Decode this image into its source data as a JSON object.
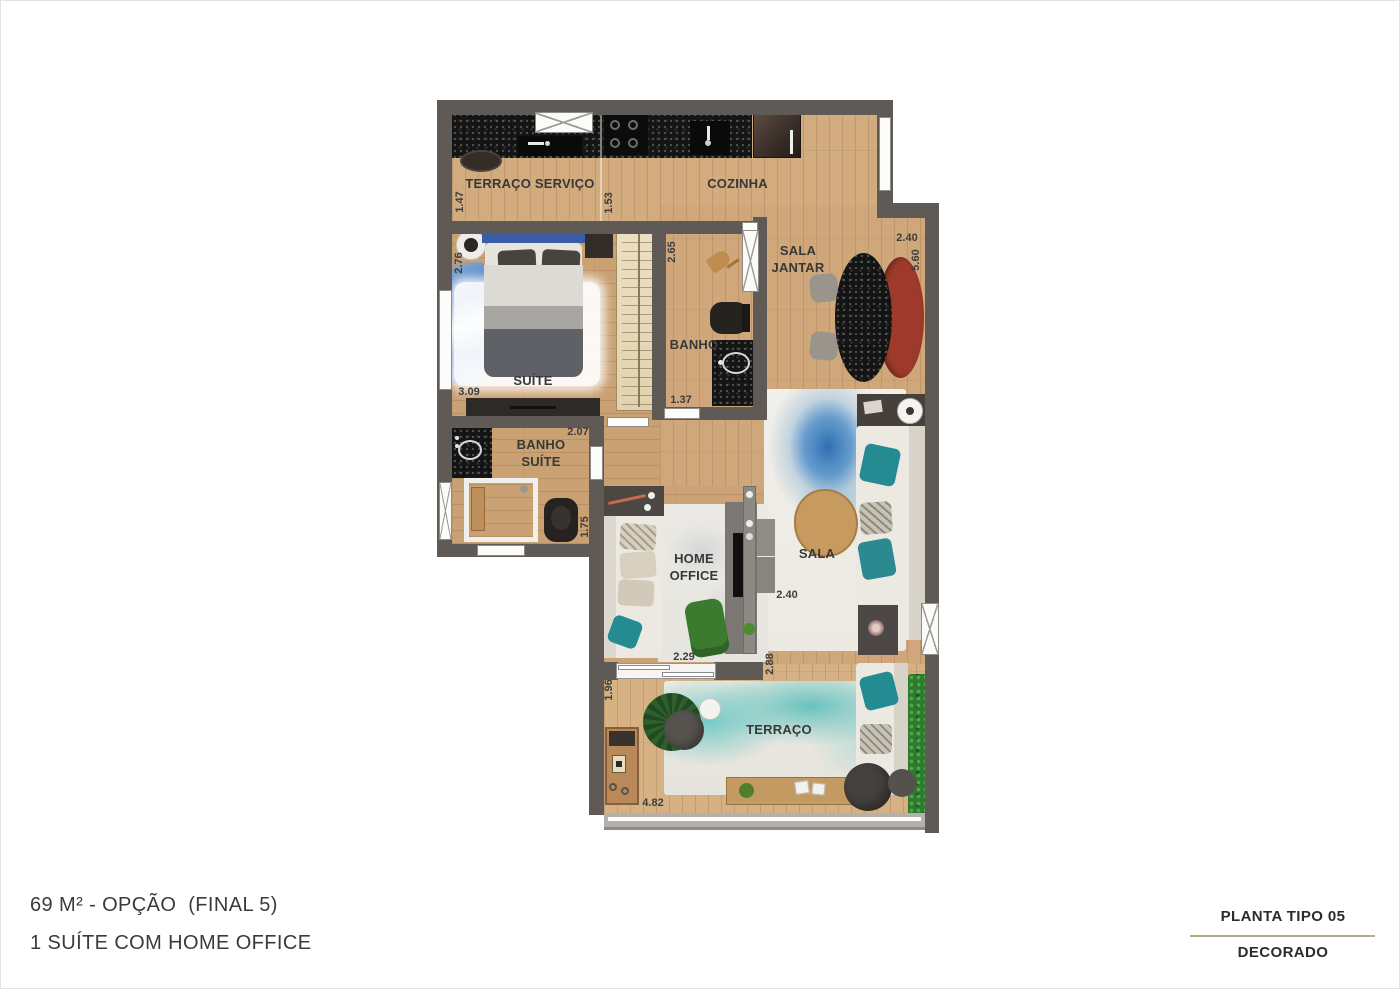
{
  "footer": {
    "area_title": "69 M² - OPÇÃO  (FINAL 5)",
    "area_subtitle": "1 SUÍTE COM HOME OFFICE",
    "plate_title": "PLANTA TIPO 05",
    "plate_subtitle": "DECORADO"
  },
  "rooms": {
    "terraco_servico": "TERRAÇO SERVIÇO",
    "cozinha": "COZINHA",
    "sala_jantar": "SALA JANTAR",
    "banho": "BANHO",
    "suite": "SUÍTE",
    "banho_suite": "BANHO SUÍTE",
    "home_office": "HOME OFFICE",
    "sala": "SALA",
    "terraco": "TERRAÇO"
  },
  "dims": {
    "servico_width": "1.47",
    "cozinha_width": "1.53",
    "banho_depth": "2.65",
    "jantar_width": "2.40",
    "jantar_depth": "5.60",
    "suite_width": "2.76",
    "suite_depth": "3.09",
    "hall_width": "1.37",
    "banho_suite_width": "2.07",
    "banho_suite_depth": "1.75",
    "home_office_width": "2.29",
    "sala_width": "2.40",
    "sala_depth": "2.88",
    "terraco_depth": "1.96",
    "terraco_width": "4.82"
  },
  "colors": {
    "wall": "#5f5a56",
    "wood": "#cfa77a",
    "divider_line": "#b5ac83",
    "accent_teal": "#238b91",
    "accent_red": "#9e3a2b"
  }
}
